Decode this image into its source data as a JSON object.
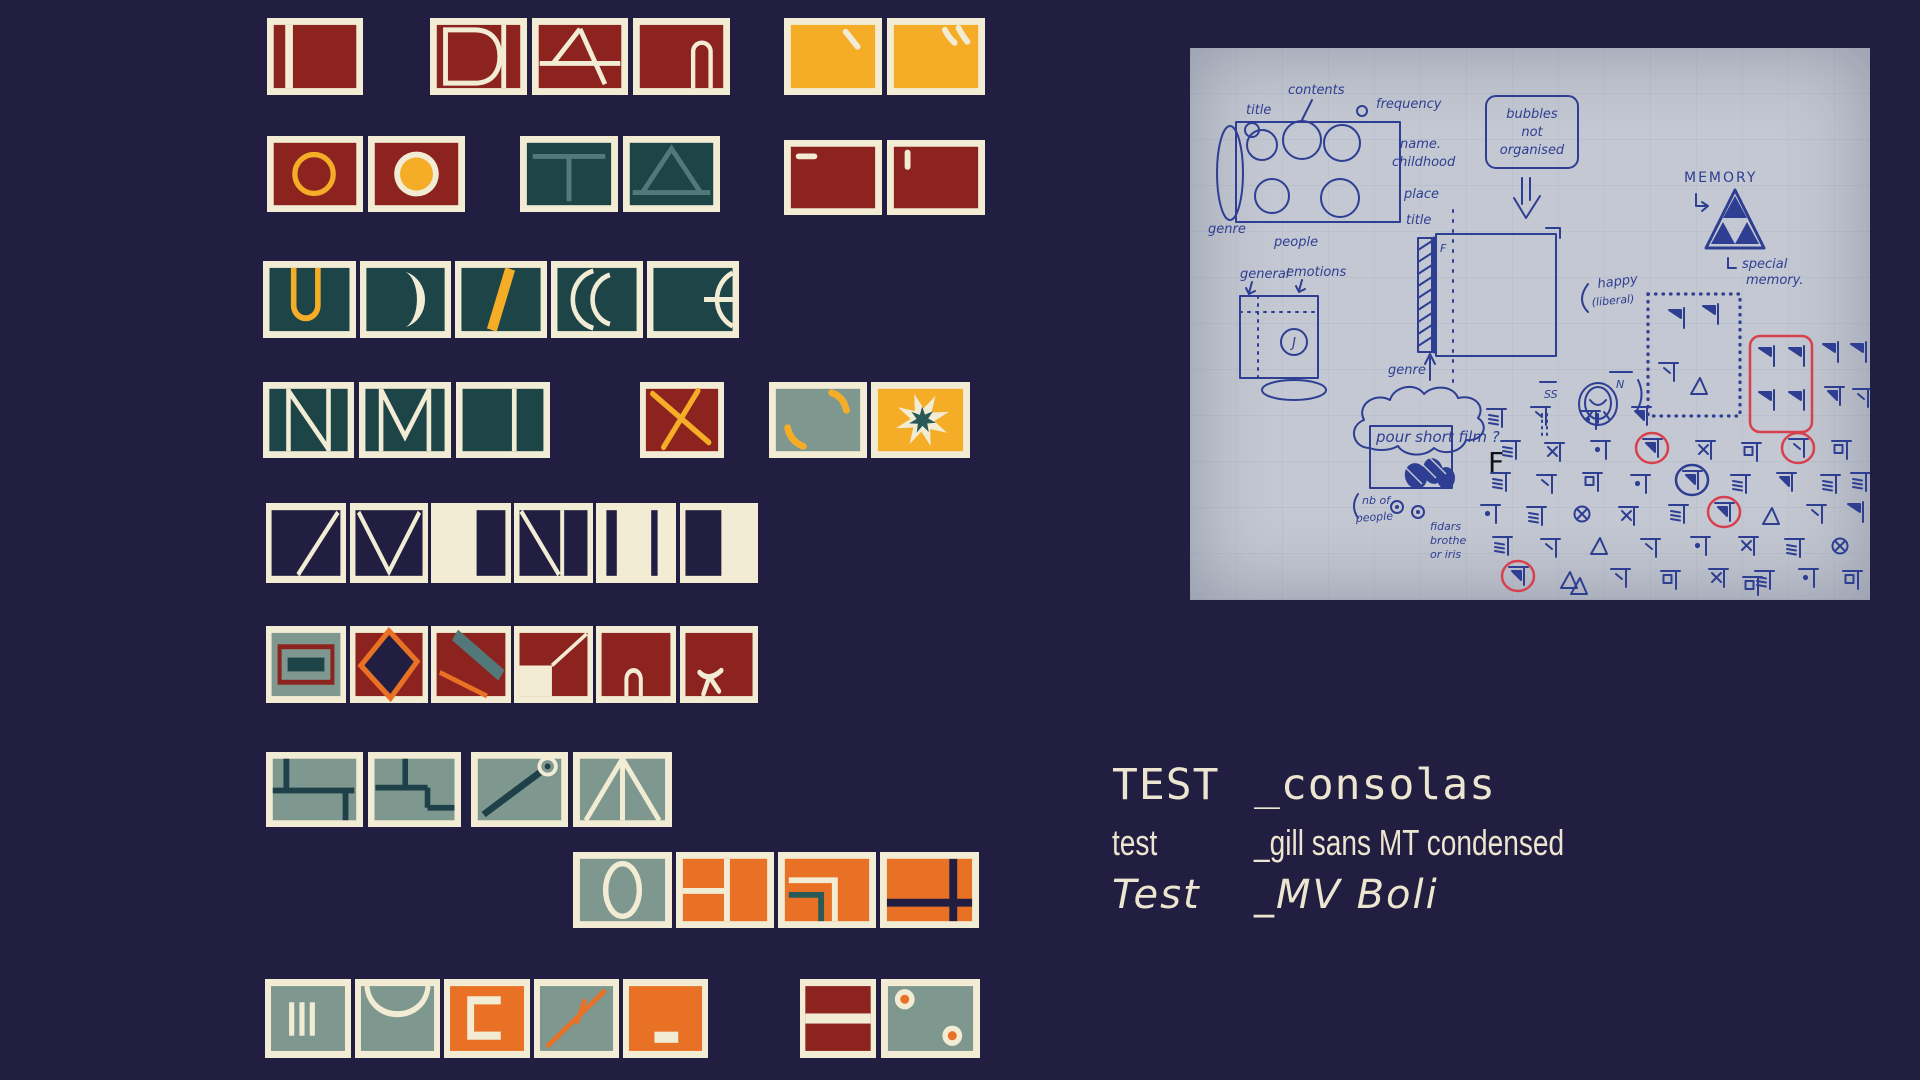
{
  "palette": {
    "navy": "#221e41",
    "cream": "#f2ecd5",
    "red": "#8c231e",
    "amber": "#f5ad27",
    "tealDark": "#1d4547",
    "tealMid": "#53787a",
    "starTeal": "#2a5a58",
    "sage": "#7e978f",
    "orange": "#e97125",
    "tealLine": "#1e4049",
    "paper": "#c3c8d2",
    "inkBlue": "#2e3e92",
    "inkRed": "#d8404e",
    "textCream": "#ece5cf"
  },
  "tiles": [
    {
      "x": 267,
      "y": 18,
      "w": 96,
      "h": 77,
      "bg": "red",
      "motif": "bar-left"
    },
    {
      "x": 430,
      "y": 18,
      "w": 97,
      "h": 77,
      "bg": "red",
      "motif": "letter-D"
    },
    {
      "x": 532,
      "y": 18,
      "w": 96,
      "h": 77,
      "bg": "red",
      "motif": "letter-A"
    },
    {
      "x": 633,
      "y": 18,
      "w": 97,
      "h": 77,
      "bg": "red",
      "motif": "arch-right"
    },
    {
      "x": 784,
      "y": 18,
      "w": 98,
      "h": 77,
      "bg": "amber",
      "motif": "tick-1"
    },
    {
      "x": 887,
      "y": 18,
      "w": 98,
      "h": 77,
      "bg": "amber",
      "motif": "tick-2"
    },
    {
      "x": 267,
      "y": 136,
      "w": 96,
      "h": 76,
      "bg": "red",
      "motif": "ring-amber"
    },
    {
      "x": 368,
      "y": 136,
      "w": 97,
      "h": 76,
      "bg": "red",
      "motif": "dot-amber"
    },
    {
      "x": 520,
      "y": 136,
      "w": 98,
      "h": 76,
      "bg": "tealDark",
      "motif": "tee"
    },
    {
      "x": 623,
      "y": 136,
      "w": 97,
      "h": 76,
      "bg": "tealDark",
      "motif": "triangle"
    },
    {
      "x": 784,
      "y": 140,
      "w": 98,
      "h": 75,
      "bg": "red",
      "motif": "dash-tl"
    },
    {
      "x": 887,
      "y": 140,
      "w": 98,
      "h": 75,
      "bg": "red",
      "motif": "tick-tl"
    },
    {
      "x": 263,
      "y": 261,
      "w": 93,
      "h": 77,
      "bg": "tealDark",
      "motif": "u-amber"
    },
    {
      "x": 360,
      "y": 261,
      "w": 91,
      "h": 77,
      "bg": "tealDark",
      "motif": "crescent-1"
    },
    {
      "x": 455,
      "y": 261,
      "w": 92,
      "h": 77,
      "bg": "tealDark",
      "motif": "slash-amber"
    },
    {
      "x": 551,
      "y": 261,
      "w": 92,
      "h": 77,
      "bg": "tealDark",
      "motif": "crescent-2"
    },
    {
      "x": 647,
      "y": 261,
      "w": 92,
      "h": 77,
      "bg": "tealDark",
      "motif": "half-e"
    },
    {
      "x": 263,
      "y": 382,
      "w": 91,
      "h": 76,
      "bg": "tealDark",
      "motif": "letter-N"
    },
    {
      "x": 359,
      "y": 382,
      "w": 92,
      "h": 76,
      "bg": "tealDark",
      "motif": "letter-M"
    },
    {
      "x": 456,
      "y": 382,
      "w": 94,
      "h": 76,
      "bg": "tealDark",
      "motif": "split-v"
    },
    {
      "x": 640,
      "y": 382,
      "w": 84,
      "h": 76,
      "bg": "red",
      "motif": "x-amber"
    },
    {
      "x": 769,
      "y": 382,
      "w": 98,
      "h": 76,
      "bg": "sage",
      "motif": "curves-amber"
    },
    {
      "x": 871,
      "y": 382,
      "w": 99,
      "h": 76,
      "bg": "amber",
      "motif": "starburst"
    },
    {
      "x": 266,
      "y": 503,
      "w": 80,
      "h": 80,
      "bg": "navy",
      "motif": "diag"
    },
    {
      "x": 350,
      "y": 503,
      "w": 78,
      "h": 80,
      "bg": "navy",
      "motif": "vee"
    },
    {
      "x": 431,
      "y": 503,
      "w": 80,
      "h": 80,
      "bg": "cream",
      "motif": "cream-right-navy"
    },
    {
      "x": 514,
      "y": 503,
      "w": 79,
      "h": 80,
      "bg": "navy",
      "motif": "diag-split"
    },
    {
      "x": 596,
      "y": 503,
      "w": 80,
      "h": 80,
      "bg": "cream",
      "motif": "cream-two-bars"
    },
    {
      "x": 680,
      "y": 503,
      "w": 78,
      "h": 80,
      "bg": "cream",
      "motif": "cream-left-navy"
    },
    {
      "x": 266,
      "y": 626,
      "w": 80,
      "h": 77,
      "bg": "sage",
      "motif": "box-minus"
    },
    {
      "x": 350,
      "y": 626,
      "w": 78,
      "h": 77,
      "bg": "red",
      "motif": "diamond"
    },
    {
      "x": 431,
      "y": 626,
      "w": 80,
      "h": 77,
      "bg": "red",
      "motif": "double-diag"
    },
    {
      "x": 514,
      "y": 626,
      "w": 79,
      "h": 77,
      "bg": "red",
      "motif": "flag"
    },
    {
      "x": 596,
      "y": 626,
      "w": 80,
      "h": 77,
      "bg": "red",
      "motif": "small-arch"
    },
    {
      "x": 680,
      "y": 626,
      "w": 78,
      "h": 77,
      "bg": "red",
      "motif": "bird"
    },
    {
      "x": 266,
      "y": 752,
      "w": 97,
      "h": 75,
      "bg": "sage",
      "motif": "path-1"
    },
    {
      "x": 368,
      "y": 752,
      "w": 93,
      "h": 75,
      "bg": "sage",
      "motif": "path-2"
    },
    {
      "x": 471,
      "y": 752,
      "w": 97,
      "h": 75,
      "bg": "sage",
      "motif": "pin-diag"
    },
    {
      "x": 573,
      "y": 752,
      "w": 99,
      "h": 75,
      "bg": "sage",
      "motif": "fan"
    },
    {
      "x": 573,
      "y": 852,
      "w": 99,
      "h": 76,
      "bg": "sage",
      "motif": "oval"
    },
    {
      "x": 676,
      "y": 852,
      "w": 98,
      "h": 76,
      "bg": "orange",
      "motif": "grid-h"
    },
    {
      "x": 778,
      "y": 852,
      "w": 98,
      "h": 76,
      "bg": "orange",
      "motif": "corner-nest"
    },
    {
      "x": 880,
      "y": 852,
      "w": 99,
      "h": 76,
      "bg": "orange",
      "motif": "cross-navy"
    },
    {
      "x": 265,
      "y": 979,
      "w": 86,
      "h": 79,
      "bg": "sage",
      "motif": "three-bars"
    },
    {
      "x": 355,
      "y": 979,
      "w": 85,
      "h": 79,
      "bg": "sage",
      "motif": "u-curve"
    },
    {
      "x": 444,
      "y": 979,
      "w": 86,
      "h": 79,
      "bg": "orange",
      "motif": "bracket-c"
    },
    {
      "x": 534,
      "y": 979,
      "w": 85,
      "h": 79,
      "bg": "sage",
      "motif": "slash-cross"
    },
    {
      "x": 623,
      "y": 979,
      "w": 85,
      "h": 79,
      "bg": "orange",
      "motif": "dash-bottom"
    },
    {
      "x": 800,
      "y": 979,
      "w": 76,
      "h": 79,
      "bg": "red",
      "motif": "stripe-mid"
    },
    {
      "x": 881,
      "y": 979,
      "w": 99,
      "h": 79,
      "bg": "sage",
      "motif": "two-dots"
    }
  ],
  "font_tests": [
    {
      "sample": "TEST",
      "font_name": "_consolas",
      "style": "mono"
    },
    {
      "sample": "test",
      "font_name": "_gill sans MT condensed",
      "style": "cond"
    },
    {
      "sample": "Test",
      "font_name": "_MV Boli",
      "style": "script"
    }
  ],
  "sketch": {
    "labels": {
      "title_top": "title",
      "contents": "contents",
      "frequency": "frequency",
      "name_dot": "name.",
      "childhood": "childhood",
      "place": "place",
      "genre_left": "genre",
      "people": "people",
      "bubbles_1": "bubbles",
      "bubbles_2": "not",
      "bubbles_3": "organised",
      "memory": "MEMORY",
      "special_1": "special",
      "special_2": "memory.",
      "happy": "happy",
      "liberal": "(liberal)",
      "title_mid": "title",
      "f_spine": "F",
      "genre_mid": "genre",
      "cloud": "pour short film ?",
      "f_marker": "F",
      "general": "general",
      "emotions": "emotions",
      "j": "J",
      "nb_of": "nb of",
      "people_2": "people",
      "fidars": "fidars",
      "brothe": "brothe",
      "or_iris": "or iris",
      "ss": "SS",
      "n": "N"
    },
    "glyphs": [
      {
        "x": 476,
        "y": 258,
        "t": 8
      },
      {
        "x": 510,
        "y": 254,
        "t": 8
      },
      {
        "x": 468,
        "y": 312,
        "t": 0
      },
      {
        "x": 498,
        "y": 326,
        "t": 7
      },
      {
        "x": 566,
        "y": 296,
        "t": 8
      },
      {
        "x": 596,
        "y": 296,
        "t": 8
      },
      {
        "x": 566,
        "y": 340,
        "t": 8
      },
      {
        "x": 596,
        "y": 340,
        "t": 8
      },
      {
        "x": 630,
        "y": 292,
        "t": 8
      },
      {
        "x": 658,
        "y": 292,
        "t": 8
      },
      {
        "x": 634,
        "y": 336,
        "t": 1
      },
      {
        "x": 662,
        "y": 338,
        "t": 0
      },
      {
        "x": 296,
        "y": 358,
        "t": 2
      },
      {
        "x": 340,
        "y": 356,
        "t": 0
      },
      {
        "x": 390,
        "y": 360,
        "t": 3
      },
      {
        "x": 441,
        "y": 356,
        "t": 1
      },
      {
        "x": 310,
        "y": 390,
        "t": 2
      },
      {
        "x": 354,
        "y": 392,
        "t": 4
      },
      {
        "x": 400,
        "y": 390,
        "t": 3
      },
      {
        "x": 452,
        "y": 388,
        "t": 1,
        "c": "red"
      },
      {
        "x": 505,
        "y": 390,
        "t": 4
      },
      {
        "x": 551,
        "y": 392,
        "t": 6
      },
      {
        "x": 598,
        "y": 388,
        "t": 0,
        "c": "red"
      },
      {
        "x": 641,
        "y": 390,
        "t": 6
      },
      {
        "x": 300,
        "y": 422,
        "t": 2
      },
      {
        "x": 346,
        "y": 424,
        "t": 0
      },
      {
        "x": 392,
        "y": 422,
        "t": 6
      },
      {
        "x": 440,
        "y": 424,
        "t": 3
      },
      {
        "x": 492,
        "y": 420,
        "t": 1,
        "c": "blue"
      },
      {
        "x": 540,
        "y": 424,
        "t": 2
      },
      {
        "x": 586,
        "y": 422,
        "t": 1
      },
      {
        "x": 630,
        "y": 424,
        "t": 2
      },
      {
        "x": 660,
        "y": 422,
        "t": 2
      },
      {
        "x": 290,
        "y": 454,
        "t": 3
      },
      {
        "x": 336,
        "y": 456,
        "t": 2
      },
      {
        "x": 382,
        "y": 454,
        "t": 5
      },
      {
        "x": 428,
        "y": 456,
        "t": 4
      },
      {
        "x": 478,
        "y": 454,
        "t": 2
      },
      {
        "x": 524,
        "y": 452,
        "t": 1,
        "c": "red"
      },
      {
        "x": 570,
        "y": 456,
        "t": 7
      },
      {
        "x": 616,
        "y": 454,
        "t": 0
      },
      {
        "x": 655,
        "y": 452,
        "t": 8
      },
      {
        "x": 302,
        "y": 486,
        "t": 2
      },
      {
        "x": 350,
        "y": 488,
        "t": 0
      },
      {
        "x": 398,
        "y": 486,
        "t": 7
      },
      {
        "x": 450,
        "y": 488,
        "t": 0
      },
      {
        "x": 500,
        "y": 486,
        "t": 3
      },
      {
        "x": 548,
        "y": 486,
        "t": 4
      },
      {
        "x": 594,
        "y": 488,
        "t": 2
      },
      {
        "x": 640,
        "y": 486,
        "t": 5
      },
      {
        "x": 318,
        "y": 516,
        "t": 1,
        "c": "red"
      },
      {
        "x": 368,
        "y": 520,
        "t": 7
      },
      {
        "x": 420,
        "y": 518,
        "t": 0
      },
      {
        "x": 470,
        "y": 520,
        "t": 6
      },
      {
        "x": 518,
        "y": 518,
        "t": 4
      },
      {
        "x": 564,
        "y": 520,
        "t": 2
      },
      {
        "x": 608,
        "y": 518,
        "t": 3
      },
      {
        "x": 652,
        "y": 520,
        "t": 6
      },
      {
        "x": 378,
        "y": 526,
        "t": 7
      },
      {
        "x": 552,
        "y": 526,
        "t": 6
      }
    ]
  }
}
